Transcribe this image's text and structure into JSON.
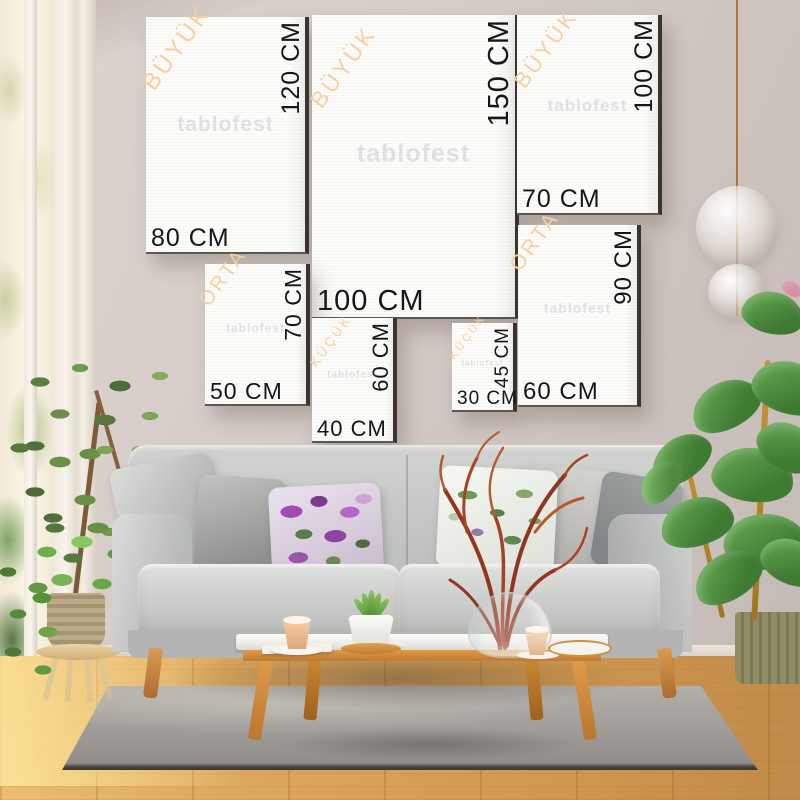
{
  "page": {
    "type": "canvas-print-size-guide",
    "watermark": "tablofest",
    "unit": "CM"
  },
  "size_categories": {
    "large": "BÜYÜK",
    "medium": "ORTA",
    "small": "KÜÇÜK"
  },
  "frames": [
    {
      "name": "80x120",
      "category": "BÜYÜK",
      "width_label": "80 CM",
      "height_label": "120 CM",
      "width_cm": 80,
      "height_cm": 120
    },
    {
      "name": "100x150",
      "category": "BÜYÜK",
      "width_label": "100 CM",
      "height_label": "150 CM",
      "width_cm": 100,
      "height_cm": 150
    },
    {
      "name": "70x100",
      "category": "BÜYÜK",
      "width_label": "70 CM",
      "height_label": "100 CM",
      "width_cm": 70,
      "height_cm": 100
    },
    {
      "name": "50x70",
      "category": "ORTA",
      "width_label": "50 CM",
      "height_label": "70 CM",
      "width_cm": 50,
      "height_cm": 70
    },
    {
      "name": "40x60",
      "category": "KÜÇÜK",
      "width_label": "40 CM",
      "height_label": "60 CM",
      "width_cm": 40,
      "height_cm": 60
    },
    {
      "name": "30x45",
      "category": "KÜÇÜK",
      "width_label": "30 CM",
      "height_label": "45 CM",
      "width_cm": 30,
      "height_cm": 45
    },
    {
      "name": "60x90",
      "category": "ORTA",
      "width_label": "60 CM",
      "height_label": "90 CM",
      "width_cm": 60,
      "height_cm": 90
    }
  ],
  "colors": {
    "category_label": "#f8cfa0",
    "dimension_label": "#161616",
    "canvas": "#f9f9f6",
    "wall": "#d2c8c4",
    "floor_wood": "#dca75e",
    "rug": "#a3a09b",
    "sofa": "#c7c9c7",
    "table_wood": "#d6913f",
    "plant_green": "#5d9b3f",
    "branch_red": "#9a3a1f"
  }
}
